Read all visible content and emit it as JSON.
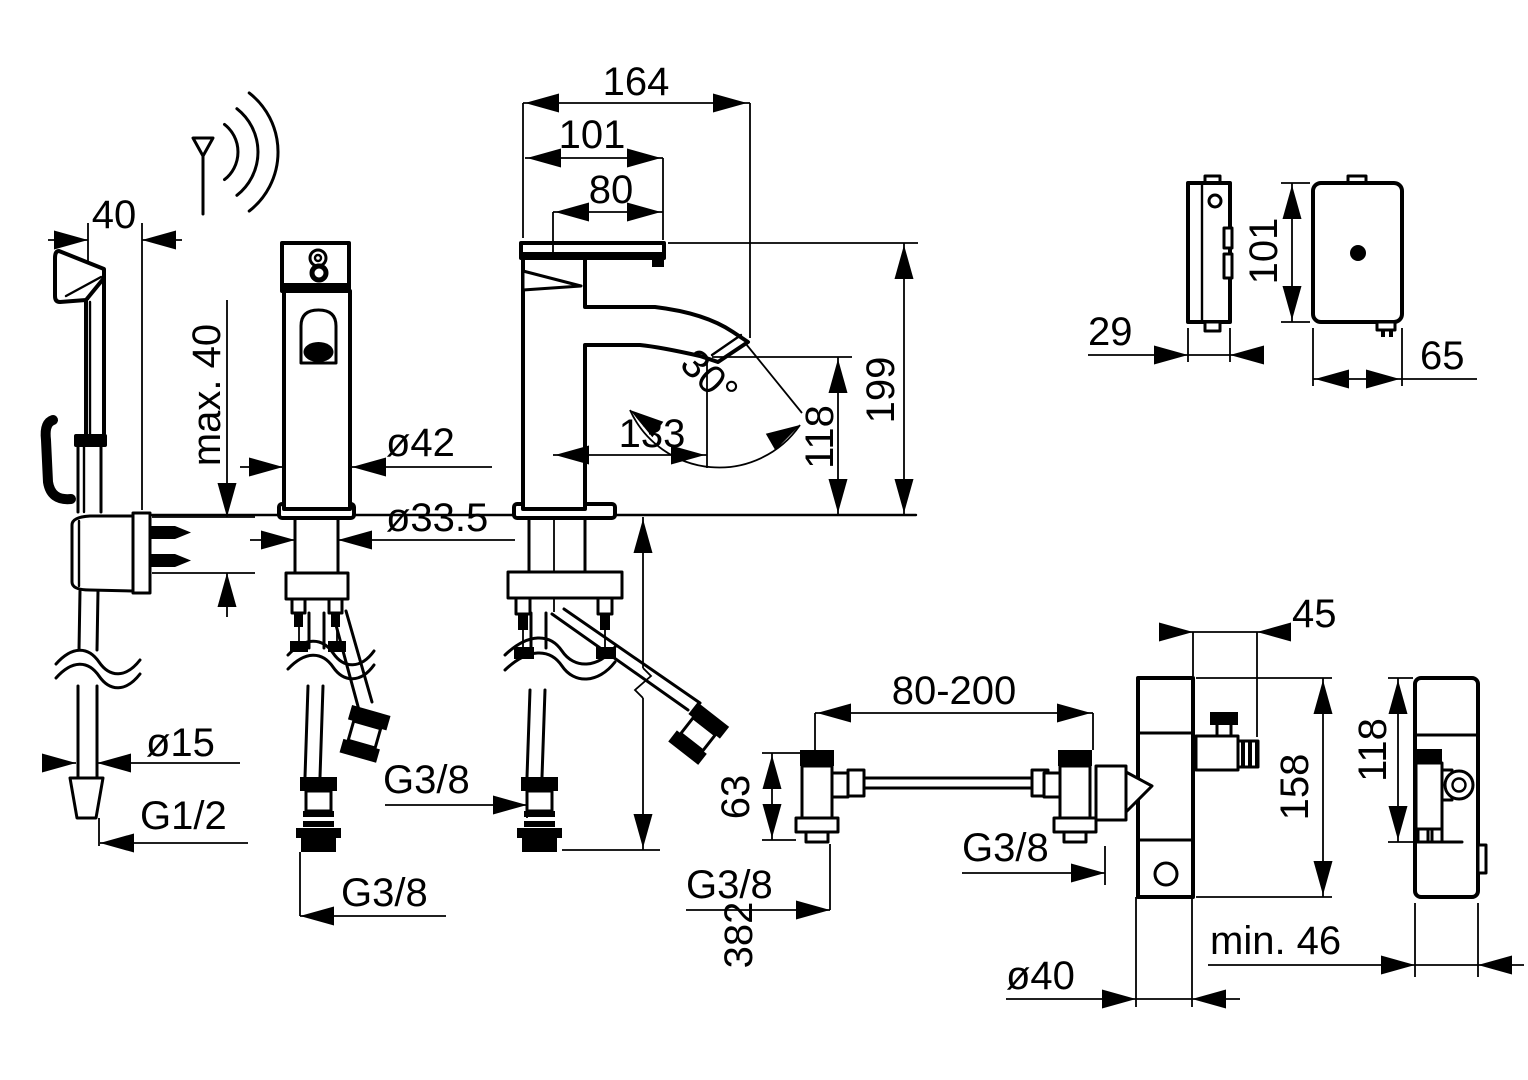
{
  "colors": {
    "line": "#000000",
    "background": "#ffffff"
  },
  "hand_shower_view": {
    "projection_width": "40",
    "max_mounting_depth": "max. 40",
    "hose_diameter": "ø15",
    "hose_thread": "G1/2"
  },
  "faucet_side_view": {
    "body_diameter": "ø42",
    "hole_diameter": "ø33.5",
    "connection_thread": "G3/8"
  },
  "faucet_front_view": {
    "total_depth": "164",
    "body_depth": "101",
    "lever_depth": "80",
    "spout_reach": "133",
    "spout_angle": "30°",
    "spout_height": "118",
    "total_height": "199",
    "hose_length_below": "382",
    "connection_thread": "G3/8"
  },
  "control_unit_views": {
    "depth": "29",
    "height": "101",
    "width": "65"
  },
  "installation_view": {
    "inlet_spacing": "80-200",
    "valve_height": "63",
    "left_inlet_thread": "G3/8",
    "right_inlet_thread": "G3/8",
    "valve_offset": "45",
    "unit_height": "158",
    "pipe_diameter": "ø40",
    "min_clearance": "min. 46",
    "unit_side_height": "118"
  }
}
